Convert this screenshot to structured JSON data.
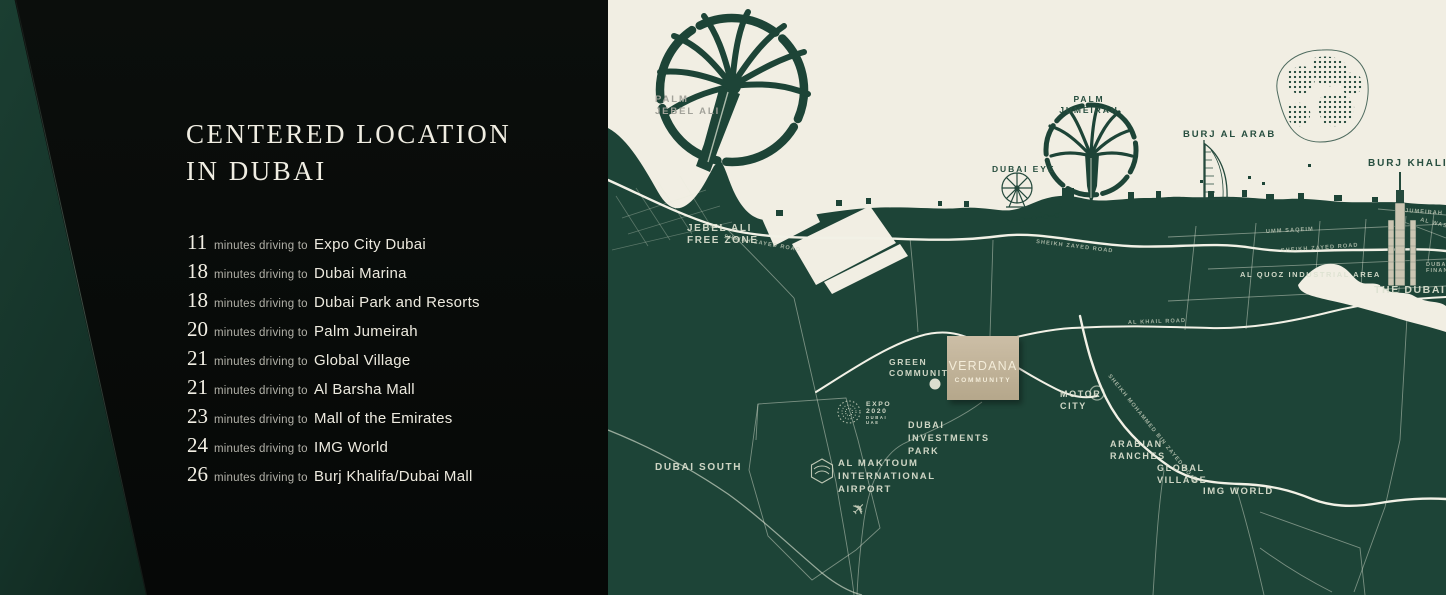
{
  "panel": {
    "title_line1": "CENTERED LOCATION",
    "title_line2": "IN DUBAI",
    "unit_label": "minutes driving to",
    "destinations": [
      {
        "minutes": "11",
        "place": "Expo City Dubai"
      },
      {
        "minutes": "18",
        "place": "Dubai Marina"
      },
      {
        "minutes": "18",
        "place": "Dubai Park and Resorts"
      },
      {
        "minutes": "20",
        "place": "Palm Jumeirah"
      },
      {
        "minutes": "21",
        "place": "Global Village"
      },
      {
        "minutes": "21",
        "place": "Al Barsha Mall"
      },
      {
        "minutes": "23",
        "place": "Mall of the Emirates"
      },
      {
        "minutes": "24",
        "place": "IMG World"
      },
      {
        "minutes": "26",
        "place": "Burj Khalifa/Dubai Mall"
      }
    ]
  },
  "map": {
    "colors": {
      "land": "#1d4437",
      "sea": "#f1eee3",
      "road": "#f2f1e6",
      "community_box": "#c3b49a",
      "label_light": "#dde2d1",
      "label_dark": "#274e3f"
    },
    "labels": {
      "palm_jebel_ali": [
        "PALM",
        "JEBEL ALI"
      ],
      "jebel_ali_free_zone": [
        "JEBEL ALI",
        "FREE ZONE"
      ],
      "palm_jumeirah": [
        "PALM",
        "JUMEIRAH"
      ],
      "dubai_eye": "DUBAI EYE",
      "burj_al_arab": "BURJ AL ARAB",
      "burj_khalifa": "BURJ KHALIFA",
      "the_dubai_mall": "THE DUBAI MALL",
      "jumeirah": "JUMEIRAH",
      "al_wasl": "AL WASL",
      "difc": [
        "DUBAI INTERNATIONAL",
        "FINANCIAL CENTRE"
      ],
      "umm_saqeim": "UMM SAQEIM",
      "al_quoz": "AL QUOZ INDUSTRIAL AREA",
      "green_community": [
        "GREEN",
        "COMMUNITY"
      ],
      "motor_city": [
        "MOTOR",
        "CITY"
      ],
      "dubai_investments_park": [
        "DUBAI",
        "INVESTMENTS",
        "PARK"
      ],
      "dubai_south": "DUBAI SOUTH",
      "al_maktoum": [
        "AL MAKTOUM",
        "INTERNATIONAL",
        "AIRPORT"
      ],
      "arabian_ranches": [
        "ARABIAN",
        "RANCHES"
      ],
      "global_village": [
        "GLOBAL",
        "VILLAGE"
      ],
      "img_world": "IMG WORLD",
      "expo": [
        "EXPO",
        "2020",
        "DUBAI",
        "UAE"
      ]
    },
    "roads": {
      "sheikh_zayed": "SHEIKH ZAYED ROAD",
      "al_khail": "AL KHAIL ROAD",
      "smbz": "SHEIKH MOHAMMED BIN ZAYED ROAD"
    },
    "community_box": {
      "line1": "VERDANA",
      "line2": "COMMUNITY"
    }
  }
}
